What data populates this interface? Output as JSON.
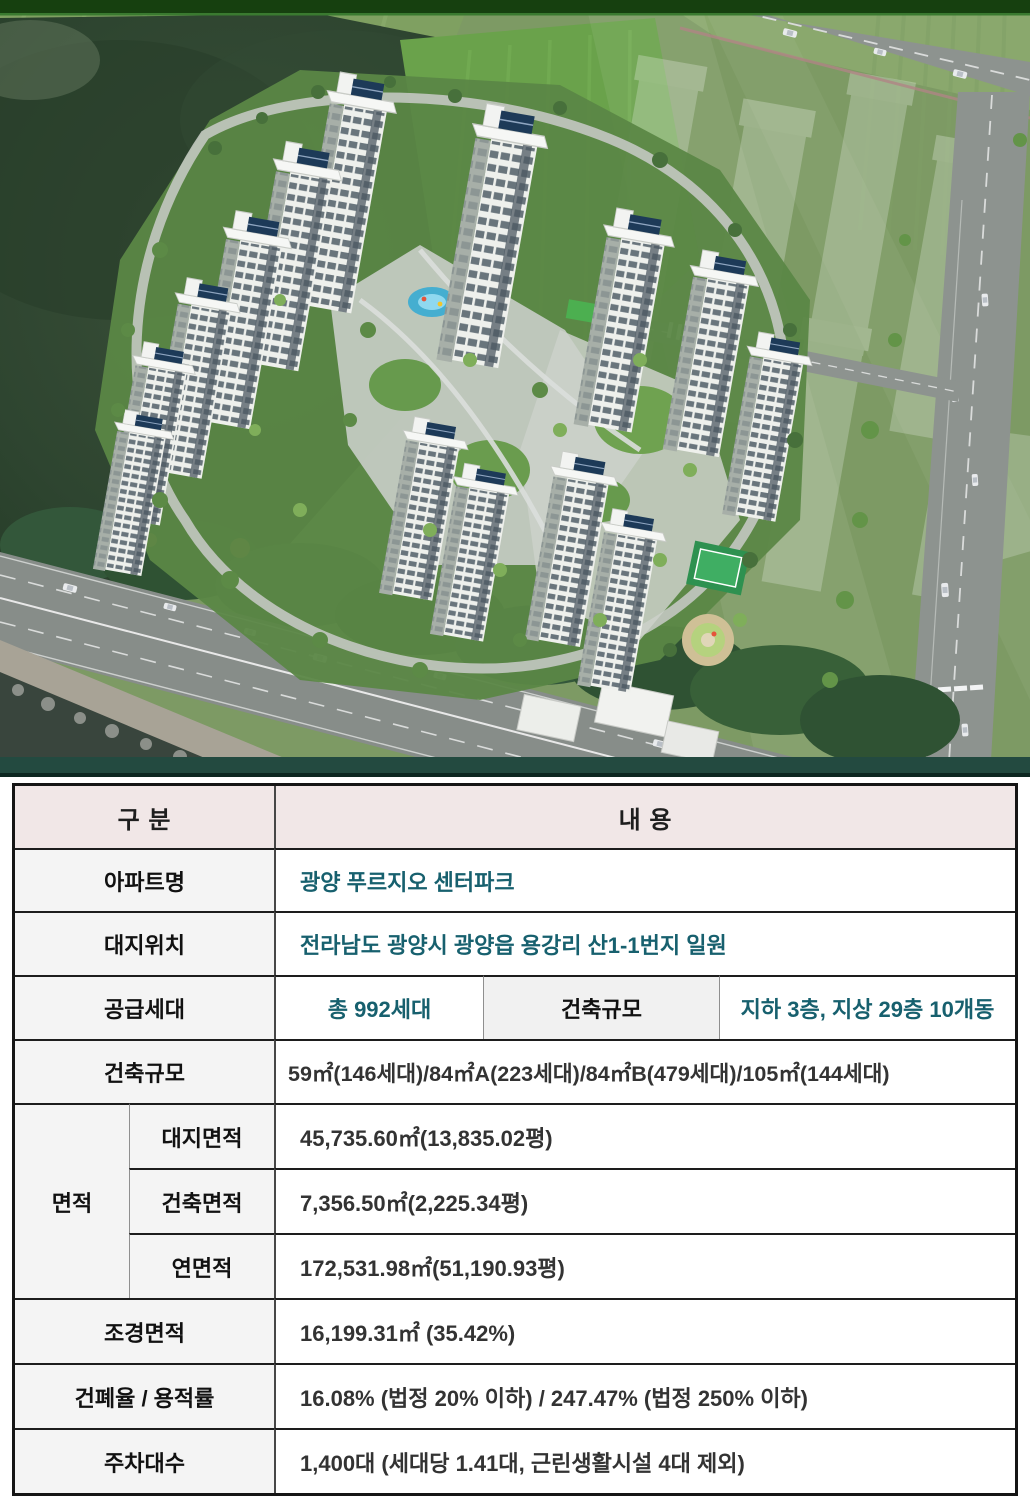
{
  "site_plan": {
    "name": "apartment-complex-aerial-rendering",
    "colors": {
      "top_strip_green": "#16400f",
      "top_strip_line": "#3a7a30",
      "forest_green": "#2e4530",
      "field_green": "#728f5a",
      "bright_field_green": "#6aa24b",
      "far_field_green": "#7d9a64",
      "road_gray": "#8d938f",
      "highway_gray": "#878d89",
      "water_dark": "#39453d",
      "tower_white": "#eef0ec",
      "tower_side": "#a7afa8",
      "solar_navy": "#1d3a58",
      "park_path": "#c9cec8",
      "lawn_green": "#679a4d",
      "pool_blue": "#45aed0",
      "court_green": "#2e9150",
      "footer_strip_teal": "#234a40"
    }
  },
  "table": {
    "header": {
      "category": "구 분",
      "content": "내 용"
    },
    "rows": {
      "apt_name": {
        "label": "아파트명",
        "value": "광양 푸르지오 센터파크"
      },
      "location": {
        "label": "대지위치",
        "value": "전라남도 광양시 광양읍 용강리 산1-1번지 일원"
      },
      "supply": {
        "label": "공급세대",
        "total": "총 992세대",
        "scale_label": "건축규모",
        "scale_value": "지하 3층, 지상 29층 10개동"
      },
      "unit_mix": {
        "label": "건축규모",
        "value": "59㎡(146세대)/84㎡A(223세대)/84㎡B(479세대)/105㎡(144세대)"
      },
      "area_group": {
        "label": "면적",
        "sub_rows": [
          {
            "label": "대지면적",
            "value": "45,735.60㎡(13,835.02평)"
          },
          {
            "label": "건축면적",
            "value": "7,356.50㎡(2,225.34평)"
          },
          {
            "label": "연면적",
            "value": "172,531.98㎡(51,190.93평)"
          }
        ]
      },
      "landscape": {
        "label": "조경면적",
        "value": "16,199.31㎡ (35.42%)"
      },
      "ratios": {
        "label": "건폐율 / 용적률",
        "value": "16.08% (법정 20% 이하) / 247.47% (법정 250% 이하)"
      },
      "parking": {
        "label": "주차대수",
        "value": "1,400대 (세대당 1.41대, 근린생활시설 4대 제외)"
      }
    }
  }
}
